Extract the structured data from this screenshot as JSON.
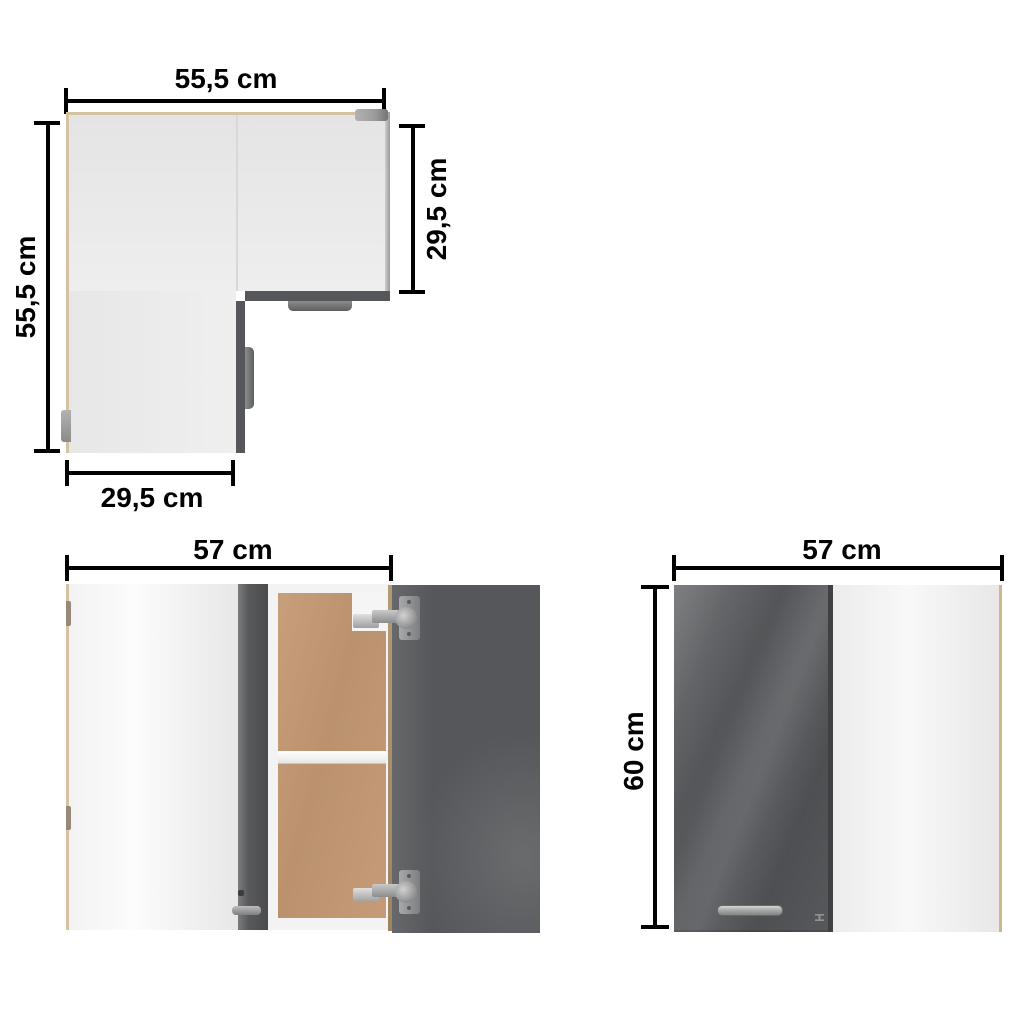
{
  "figures": {
    "top_view": {
      "dim_top": "55,5 cm",
      "dim_left": "55,5 cm",
      "dim_right": "29,5 cm",
      "dim_bottom": "29,5 cm"
    },
    "front_open_view": {
      "dim_width": "57 cm",
      "dim_upper_compartment": "27,5 cm",
      "dim_lower_compartment": "27,5 cm"
    },
    "front_closed_view": {
      "dim_width": "57 cm",
      "dim_height": "60 cm"
    }
  },
  "colors": {
    "background": "#ffffff",
    "dimension_line": "#000000",
    "carcass_light_gray": "#eaeaea",
    "panel_white": "#f5f5f5",
    "edge_tan": "#d5c2a0",
    "door_dark_gray": "#55575a",
    "glossy_door_gray": "#54565a",
    "back_panel_mdf": "#c49b77",
    "hardware_metal": "#a8a9ab"
  }
}
